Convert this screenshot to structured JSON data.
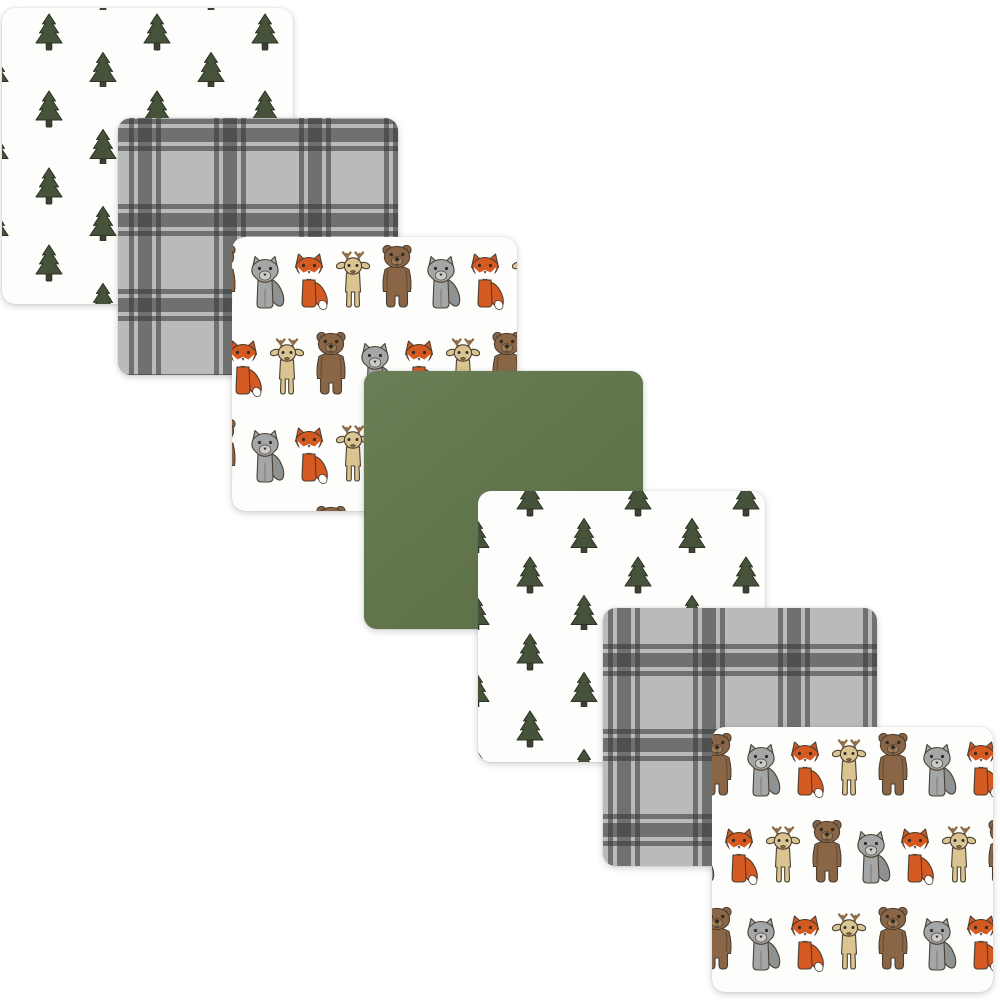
{
  "page": {
    "background_color": "#ffffff",
    "alt_text": "Product photo: 7-pack of flannel receiving blankets in a forest woodland theme, fanned diagonally from top-left to bottom-right"
  },
  "blankets": [
    {
      "index": 1,
      "pattern": "pine-trees",
      "label": "White flannel blanket with dark green pine tree print"
    },
    {
      "index": 2,
      "pattern": "gray-plaid",
      "label": "Gray windowpane plaid flannel blanket"
    },
    {
      "index": 3,
      "pattern": "woodland-animals",
      "label": "White flannel blanket with woodland animal print: wolf, fox, deer and bear"
    },
    {
      "index": 4,
      "pattern": "solid-green",
      "label": "Solid forest green flannel blanket"
    },
    {
      "index": 5,
      "pattern": "pine-trees",
      "label": "White flannel blanket with dark green pine tree print"
    },
    {
      "index": 6,
      "pattern": "gray-plaid",
      "label": "Gray windowpane plaid flannel blanket"
    },
    {
      "index": 7,
      "pattern": "woodland-animals",
      "label": "White flannel blanket with woodland animal print: wolf, fox, deer and bear"
    }
  ],
  "motifs": {
    "tree": "evergreen pine tree",
    "animals": [
      "wolf",
      "fox",
      "deer",
      "bear"
    ],
    "plaid": "windowpane plaid"
  },
  "colors": {
    "tree_green": "#46523a",
    "tree_outline": "#2d3425",
    "trunk": "#3e4033",
    "solid_green": "#60744a",
    "plaid_base": "#b9bbba",
    "plaid_line": "rgba(50,52,51,0.55)",
    "fox_orange": "#d45a21",
    "fox_inner": "#a8441a",
    "wolf_gray": "#a4a6a7",
    "wolf_shade": "#8f9293",
    "wolf_muzzle": "#c9cbcb",
    "deer_tan": "#d9c492",
    "antler_brown": "#8e6e49",
    "deer_nose": "#8c6c4d",
    "bear_brown": "#8a6546",
    "bear_shade": "#755640",
    "bear_muzzle": "#9d7b57",
    "outline": "#4b3e30",
    "feature_dark": "#332d26",
    "blanket_white": "#fdfdfc"
  }
}
